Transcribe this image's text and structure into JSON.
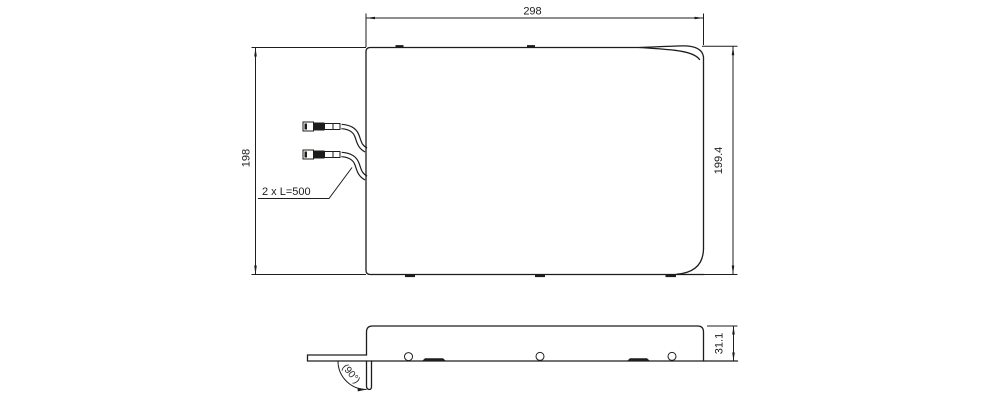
{
  "drawing": {
    "background_color": "#ffffff",
    "line_color": "#1d1d1b",
    "top_view": {
      "width_dim_label": "298",
      "height_left_dim_label": "198",
      "height_right_dim_label": "199.4",
      "cable_note_label": "2 x L=500"
    },
    "side_view": {
      "height_dim_label": "31.1",
      "bend_angle_label": "(90°)"
    }
  }
}
